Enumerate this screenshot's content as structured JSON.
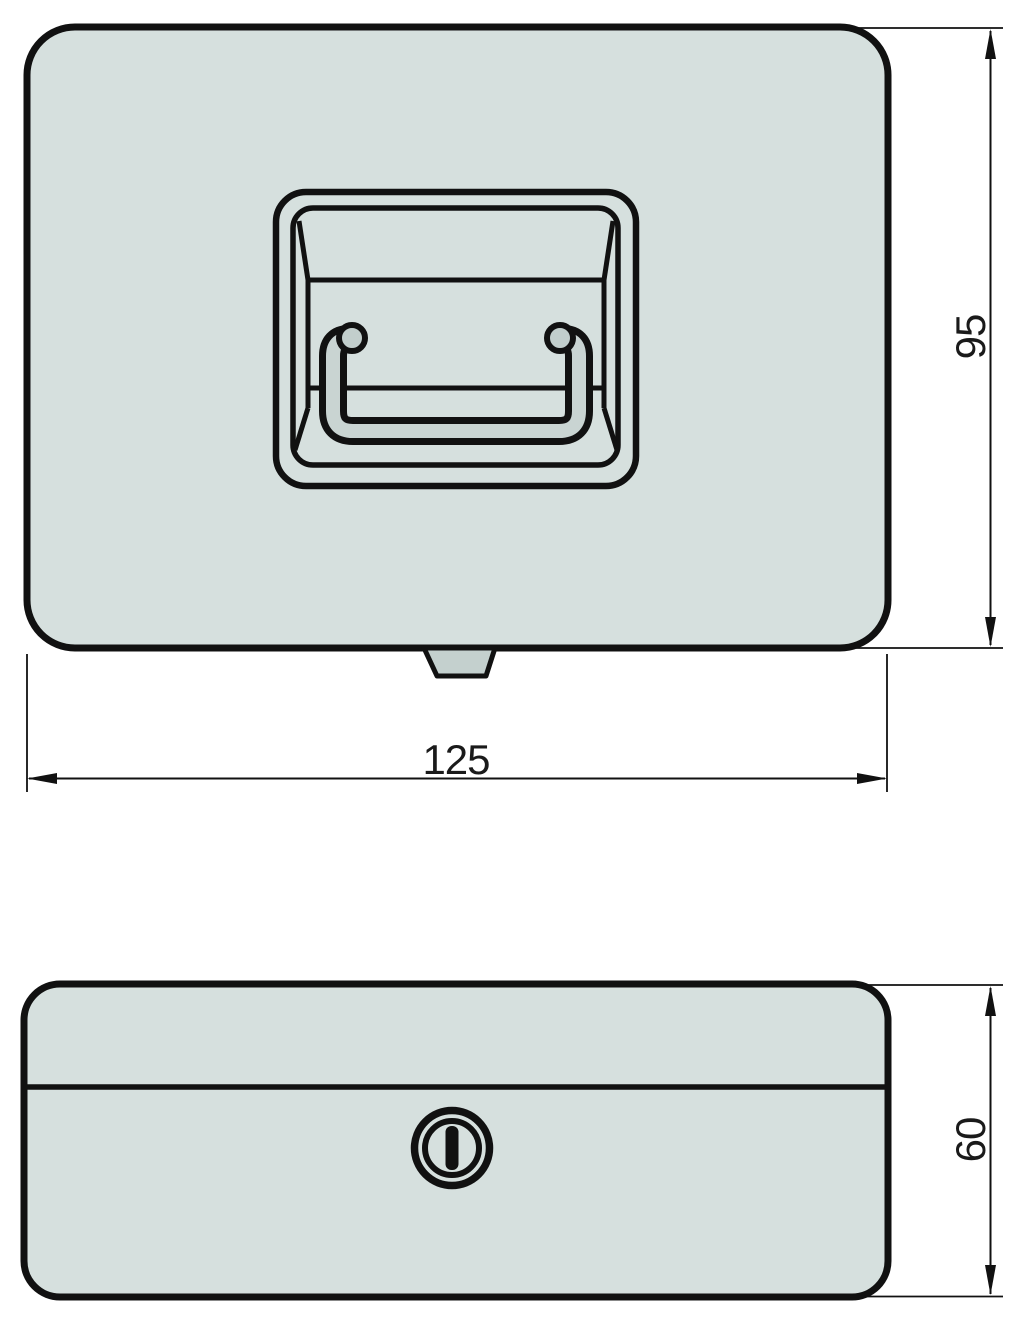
{
  "drawing": {
    "type": "technical-drawing",
    "subject": "cash-box-with-folding-handle-and-key-lock",
    "views": {
      "top_view": {
        "features": [
          "rounded-rectangular-lid",
          "recessed-folding-handle",
          "front-latch-tab"
        ]
      },
      "front_view": {
        "features": [
          "rounded-rectangular-body",
          "lid-seam-line",
          "keyhole"
        ]
      }
    },
    "dimensions": {
      "width": {
        "value": "125",
        "view": "top_view",
        "orientation": "horizontal"
      },
      "depth": {
        "value": "95",
        "view": "top_view",
        "orientation": "vertical"
      },
      "height": {
        "value": "60",
        "view": "front_view",
        "orientation": "vertical"
      }
    },
    "icons": {
      "keyhole": "double-ring-with-vertical-slot"
    },
    "colors": {
      "background": "#ffffff",
      "line": "#111111",
      "body_fill": "#d6e0de",
      "handle_bar_fill": "#c9d4d2",
      "pivot_fill": "#c2cecc",
      "latch_fill": "#c4d0ce",
      "text": "#1a1a1a"
    }
  }
}
